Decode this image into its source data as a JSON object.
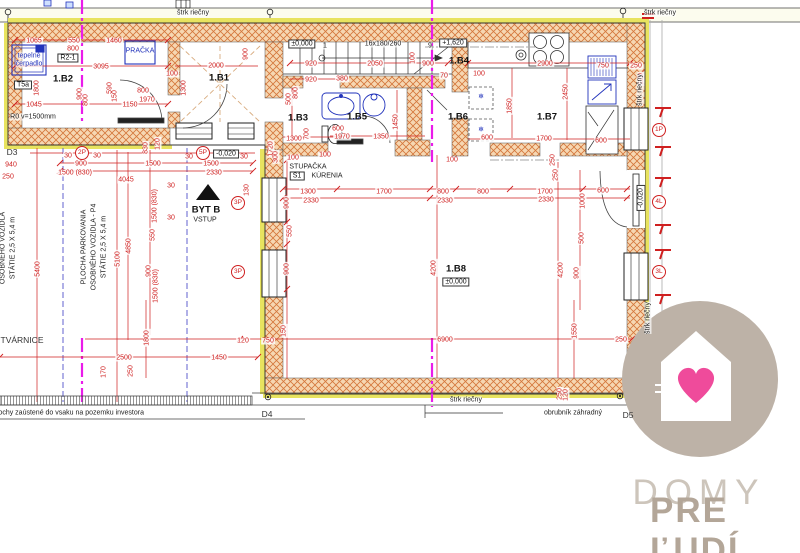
{
  "colors": {
    "wall_hatch": "#d4763b",
    "wall_fill": "#f6d7b2",
    "insulation": "#e8e35f",
    "dimension": "#cf2020",
    "fixture_blue": "#2233bb",
    "section_magenta": "#ea1bea",
    "axis_blue": "#6060cf",
    "logo_circle": "#bdb2a7",
    "logo_heart": "#ef4b9b",
    "logo_text_light": "#cdc5bb",
    "logo_text_dark": "#b3a698"
  },
  "logo": {
    "word1": "DOMY",
    "word2": "PRE ĽUDÍ"
  },
  "annotations": [
    {
      "t": "štrk riečny",
      "x": 193,
      "y": 13,
      "k": "lbl",
      "n": "gravel-strip-label"
    },
    {
      "t": "štrk riečny",
      "x": 660,
      "y": 13,
      "k": "lbl",
      "n": "gravel-strip-label"
    },
    {
      "t": "1065",
      "x": 34,
      "y": 41
    },
    {
      "t": "550",
      "x": 74,
      "y": 41
    },
    {
      "t": "800",
      "x": 73,
      "y": 49
    },
    {
      "t": "1460",
      "x": 114,
      "y": 41
    },
    {
      "t": "3095",
      "x": 101,
      "y": 67
    },
    {
      "t": "1045",
      "x": 34,
      "y": 105
    },
    {
      "t": "1150",
      "x": 130,
      "y": 105
    },
    {
      "t": "1970",
      "x": 147,
      "y": 100
    },
    {
      "t": "800",
      "x": 143,
      "y": 91
    },
    {
      "t": "1800",
      "x": 37,
      "y": 88,
      "k": "dimv"
    },
    {
      "t": "900",
      "x": 80,
      "y": 94,
      "k": "dimv"
    },
    {
      "t": "800",
      "x": 86,
      "y": 100,
      "k": "dimv"
    },
    {
      "t": "590",
      "x": 110,
      "y": 88,
      "k": "dimv"
    },
    {
      "t": "150",
      "x": 115,
      "y": 96,
      "k": "dimv"
    },
    {
      "t": "tepelné",
      "x": 29,
      "y": 56,
      "k": "blue",
      "n": "heat-pump-label"
    },
    {
      "t": "čerpadlo",
      "x": 29,
      "y": 64,
      "k": "blue",
      "n": "heat-pump-label"
    },
    {
      "t": "PRAČKA",
      "x": 140,
      "y": 51,
      "k": "blue",
      "n": "washer-label"
    },
    {
      "t": "T5a",
      "x": 23,
      "y": 85,
      "k": "lvl"
    },
    {
      "t": "R2-1",
      "x": 68,
      "y": 58,
      "k": "lvl"
    },
    {
      "t": "R0 v=1500mm",
      "x": 33,
      "y": 117,
      "k": "lbl"
    },
    {
      "t": "1.B2",
      "x": 63,
      "y": 79,
      "k": "room",
      "n": "room-label-1b2"
    },
    {
      "t": "1.B1",
      "x": 219,
      "y": 78,
      "k": "room",
      "n": "room-label-1b1"
    },
    {
      "t": "2000",
      "x": 216,
      "y": 66
    },
    {
      "t": "900",
      "x": 246,
      "y": 54,
      "k": "dimv"
    },
    {
      "t": "1300",
      "x": 184,
      "y": 88,
      "k": "dimv"
    },
    {
      "t": "100",
      "x": 172,
      "y": 74
    },
    {
      "t": "±0,000",
      "x": 302,
      "y": 44,
      "k": "lvl",
      "n": "level-mark"
    },
    {
      "t": "1",
      "x": 325,
      "y": 46,
      "k": "lbl"
    },
    {
      "t": "16x180/260",
      "x": 383,
      "y": 44,
      "k": "lbl",
      "n": "stair-spec"
    },
    {
      "t": "9",
      "x": 430,
      "y": 46,
      "k": "lbl"
    },
    {
      "t": "+1,620",
      "x": 453,
      "y": 43,
      "k": "lvl",
      "n": "level-mark"
    },
    {
      "t": "1.B4",
      "x": 459,
      "y": 61,
      "k": "room",
      "n": "room-label-1b4"
    },
    {
      "t": "920",
      "x": 311,
      "y": 64
    },
    {
      "t": "2050",
      "x": 375,
      "y": 64
    },
    {
      "t": "900",
      "x": 428,
      "y": 64
    },
    {
      "t": "100",
      "x": 413,
      "y": 58,
      "k": "dimv"
    },
    {
      "t": "70",
      "x": 444,
      "y": 76
    },
    {
      "t": "920",
      "x": 311,
      "y": 80
    },
    {
      "t": "380",
      "x": 342,
      "y": 79
    },
    {
      "t": "1.B3",
      "x": 298,
      "y": 118,
      "k": "room",
      "n": "room-label-1b3"
    },
    {
      "t": "1.B5",
      "x": 357,
      "y": 117,
      "k": "room",
      "n": "room-label-1b5"
    },
    {
      "t": "1.B6",
      "x": 458,
      "y": 117,
      "k": "room",
      "n": "room-label-1b6"
    },
    {
      "t": "1.B7",
      "x": 547,
      "y": 117,
      "k": "room",
      "n": "room-label-1b7"
    },
    {
      "t": "500",
      "x": 289,
      "y": 99,
      "k": "dimv"
    },
    {
      "t": "800",
      "x": 296,
      "y": 93,
      "k": "dimv"
    },
    {
      "t": "700",
      "x": 307,
      "y": 134,
      "k": "dimv"
    },
    {
      "t": "1300",
      "x": 294,
      "y": 139
    },
    {
      "t": "600",
      "x": 338,
      "y": 129
    },
    {
      "t": "1970",
      "x": 342,
      "y": 137
    },
    {
      "t": "1350",
      "x": 381,
      "y": 137
    },
    {
      "t": "1450",
      "x": 396,
      "y": 122,
      "k": "dimv"
    },
    {
      "t": "STUPAČKA",
      "x": 308,
      "y": 167,
      "k": "lbl",
      "n": "riser-label"
    },
    {
      "t": "S1",
      "x": 297,
      "y": 176,
      "k": "lvl"
    },
    {
      "t": "KÚRENIA",
      "x": 327,
      "y": 176,
      "k": "lbl",
      "n": "riser-label"
    },
    {
      "t": "100",
      "x": 293,
      "y": 158
    },
    {
      "t": "100",
      "x": 325,
      "y": 155
    },
    {
      "t": "100",
      "x": 452,
      "y": 160
    },
    {
      "t": "❄",
      "x": 481,
      "y": 97,
      "k": "blue",
      "n": "freezer-icon"
    },
    {
      "t": "❄",
      "x": 481,
      "y": 130,
      "k": "blue",
      "n": "freezer-icon"
    },
    {
      "t": "100",
      "x": 479,
      "y": 74
    },
    {
      "t": "600",
      "x": 487,
      "y": 138
    },
    {
      "t": "2900",
      "x": 545,
      "y": 64
    },
    {
      "t": "1850",
      "x": 510,
      "y": 106,
      "k": "dimv"
    },
    {
      "t": "2450",
      "x": 566,
      "y": 92,
      "k": "dimv"
    },
    {
      "t": "1700",
      "x": 544,
      "y": 139
    },
    {
      "t": "600",
      "x": 601,
      "y": 141
    },
    {
      "t": "750",
      "x": 603,
      "y": 66
    },
    {
      "t": "250",
      "x": 636,
      "y": 66
    },
    {
      "t": "120",
      "x": 641,
      "y": 79,
      "k": "dimv"
    },
    {
      "t": "1P",
      "x": 659,
      "y": 130,
      "k": "circ",
      "n": "opening-marker-1p"
    },
    {
      "t": "4L",
      "x": 659,
      "y": 202,
      "k": "circ",
      "n": "opening-marker-4l"
    },
    {
      "t": "3L",
      "x": 659,
      "y": 272,
      "k": "circ",
      "n": "opening-marker-3l"
    },
    {
      "t": "-0,020",
      "x": 641,
      "y": 198,
      "k": "lvlv",
      "n": "level-mark"
    },
    {
      "t": "štrk riečny",
      "x": 640,
      "y": 90,
      "k": "lblv",
      "n": "gravel-strip-label"
    },
    {
      "t": "štrk riečny",
      "x": 648,
      "y": 318,
      "k": "lblv",
      "n": "gravel-strip-label"
    },
    {
      "t": "1300",
      "x": 308,
      "y": 192
    },
    {
      "t": "1700",
      "x": 384,
      "y": 192
    },
    {
      "t": "800",
      "x": 443,
      "y": 192
    },
    {
      "t": "800",
      "x": 483,
      "y": 192
    },
    {
      "t": "1700",
      "x": 545,
      "y": 192
    },
    {
      "t": "600",
      "x": 603,
      "y": 191
    },
    {
      "t": "2330",
      "x": 311,
      "y": 201
    },
    {
      "t": "2330",
      "x": 445,
      "y": 201
    },
    {
      "t": "2330",
      "x": 546,
      "y": 200
    },
    {
      "t": "4200",
      "x": 434,
      "y": 268,
      "k": "dimv"
    },
    {
      "t": "4200",
      "x": 561,
      "y": 270,
      "k": "dimv"
    },
    {
      "t": "900",
      "x": 287,
      "y": 203,
      "k": "dimv"
    },
    {
      "t": "550",
      "x": 290,
      "y": 231,
      "k": "dimv"
    },
    {
      "t": "900",
      "x": 287,
      "y": 269,
      "k": "dimv"
    },
    {
      "t": "1720",
      "x": 271,
      "y": 149,
      "k": "dimv"
    },
    {
      "t": "300",
      "x": 276,
      "y": 157,
      "k": "dimv"
    },
    {
      "t": "1000",
      "x": 583,
      "y": 201,
      "k": "dimv"
    },
    {
      "t": "500",
      "x": 582,
      "y": 238,
      "k": "dimv"
    },
    {
      "t": "900",
      "x": 577,
      "y": 273,
      "k": "dimv"
    },
    {
      "t": "250",
      "x": 553,
      "y": 160,
      "k": "dimv"
    },
    {
      "t": "250",
      "x": 556,
      "y": 175,
      "k": "dimv"
    },
    {
      "t": "1.B8",
      "x": 456,
      "y": 269,
      "k": "room",
      "n": "room-label-1b8"
    },
    {
      "t": "±0,000",
      "x": 456,
      "y": 282,
      "k": "lvl",
      "n": "level-mark"
    },
    {
      "t": "D3",
      "x": 12,
      "y": 152,
      "k": "lbl9",
      "n": "detail-marker-d3"
    },
    {
      "t": "2P",
      "x": 82,
      "y": 153,
      "k": "circ",
      "n": "parking-marker-2p"
    },
    {
      "t": "5P",
      "x": 203,
      "y": 153,
      "k": "circ",
      "n": "parking-marker-5p"
    },
    {
      "t": "-0,020",
      "x": 226,
      "y": 154,
      "k": "lvl",
      "n": "level-mark"
    },
    {
      "t": "30",
      "x": 68,
      "y": 156
    },
    {
      "t": "30",
      "x": 97,
      "y": 156
    },
    {
      "t": "30",
      "x": 189,
      "y": 157
    },
    {
      "t": "30",
      "x": 244,
      "y": 157
    },
    {
      "t": "900",
      "x": 81,
      "y": 164
    },
    {
      "t": "1500 (830)",
      "x": 75,
      "y": 173
    },
    {
      "t": "940",
      "x": 11,
      "y": 165
    },
    {
      "t": "250",
      "x": 8,
      "y": 177
    },
    {
      "t": "1500",
      "x": 153,
      "y": 164
    },
    {
      "t": "4045",
      "x": 126,
      "y": 180
    },
    {
      "t": "1500",
      "x": 211,
      "y": 164
    },
    {
      "t": "2330",
      "x": 214,
      "y": 173
    },
    {
      "t": "830",
      "x": 146,
      "y": 148,
      "k": "dimv"
    },
    {
      "t": "120",
      "x": 158,
      "y": 144,
      "k": "dimv"
    },
    {
      "t": "BYT B",
      "x": 206,
      "y": 210,
      "k": "room",
      "n": "entrance-label"
    },
    {
      "t": "VSTUP",
      "x": 205,
      "y": 220,
      "k": "lbl",
      "n": "entrance-label"
    },
    {
      "t": "3P",
      "x": 238,
      "y": 203,
      "k": "circ",
      "n": "parking-marker-3p"
    },
    {
      "t": "3P",
      "x": 238,
      "y": 272,
      "k": "circ",
      "n": "parking-marker-3p"
    },
    {
      "t": "PLOCHA PARKOVANIA",
      "x": 84,
      "y": 247,
      "k": "lblv",
      "n": "parking-text"
    },
    {
      "t": "OSOBNÉHO VOZIDLA - P4",
      "x": 94,
      "y": 247,
      "k": "lblv",
      "n": "parking-text"
    },
    {
      "t": "STÁTIE 2,5 X 5,4 m",
      "x": 104,
      "y": 247,
      "k": "lblv",
      "n": "parking-text"
    },
    {
      "t": "OSOBNÉHO VOZIDLA",
      "x": 3,
      "y": 248,
      "k": "lblv",
      "n": "parking-text"
    },
    {
      "t": "STÁTIE 2,5 X 5,4 m",
      "x": 13,
      "y": 248,
      "k": "lblv",
      "n": "parking-text"
    },
    {
      "t": "5400",
      "x": 38,
      "y": 269,
      "k": "dimv"
    },
    {
      "t": "5100",
      "x": 118,
      "y": 259,
      "k": "dimv"
    },
    {
      "t": "4850",
      "x": 129,
      "y": 246,
      "k": "dimv"
    },
    {
      "t": "1500 (830)",
      "x": 155,
      "y": 206,
      "k": "dimv"
    },
    {
      "t": "550",
      "x": 153,
      "y": 235,
      "k": "dimv"
    },
    {
      "t": "900",
      "x": 149,
      "y": 271,
      "k": "dimv"
    },
    {
      "t": "1500 (830)",
      "x": 156,
      "y": 286,
      "k": "dimv"
    },
    {
      "t": "30",
      "x": 171,
      "y": 186
    },
    {
      "t": "30",
      "x": 171,
      "y": 218
    },
    {
      "t": "130",
      "x": 247,
      "y": 190,
      "k": "dimv"
    },
    {
      "t": "TVÁRNICE",
      "x": 22,
      "y": 340,
      "k": "lbl9",
      "n": "tvarnice-label"
    },
    {
      "t": "2500",
      "x": 124,
      "y": 358
    },
    {
      "t": "1450",
      "x": 219,
      "y": 358
    },
    {
      "t": "1800",
      "x": 147,
      "y": 338,
      "k": "dimv"
    },
    {
      "t": "120",
      "x": 243,
      "y": 341
    },
    {
      "t": "750",
      "x": 268,
      "y": 341
    },
    {
      "t": "6900",
      "x": 445,
      "y": 340
    },
    {
      "t": "150",
      "x": 284,
      "y": 331,
      "k": "dimv"
    },
    {
      "t": "170",
      "x": 104,
      "y": 372,
      "k": "dimv"
    },
    {
      "t": "250",
      "x": 131,
      "y": 371,
      "k": "dimv"
    },
    {
      "t": "plochy zaústené do vsaku na pozemku investora",
      "x": -7,
      "y": 413,
      "k": "lbl left",
      "n": "drainage-note"
    },
    {
      "t": "D4",
      "x": 267,
      "y": 414,
      "k": "lbl9",
      "n": "detail-marker-d4"
    },
    {
      "t": "štrk riečny",
      "x": 466,
      "y": 400,
      "k": "lbl",
      "n": "gravel-strip-label"
    },
    {
      "t": "obrubník záhradný",
      "x": 573,
      "y": 413,
      "k": "lbl",
      "n": "curb-label"
    },
    {
      "t": "D5",
      "x": 628,
      "y": 415,
      "k": "lbl9",
      "n": "detail-marker-d5"
    },
    {
      "t": "1550",
      "x": 575,
      "y": 331,
      "k": "dimv"
    },
    {
      "t": "250",
      "x": 560,
      "y": 394,
      "k": "dimv"
    },
    {
      "t": "120",
      "x": 566,
      "y": 395,
      "k": "dimv"
    },
    {
      "t": "250",
      "x": 621,
      "y": 340
    }
  ]
}
